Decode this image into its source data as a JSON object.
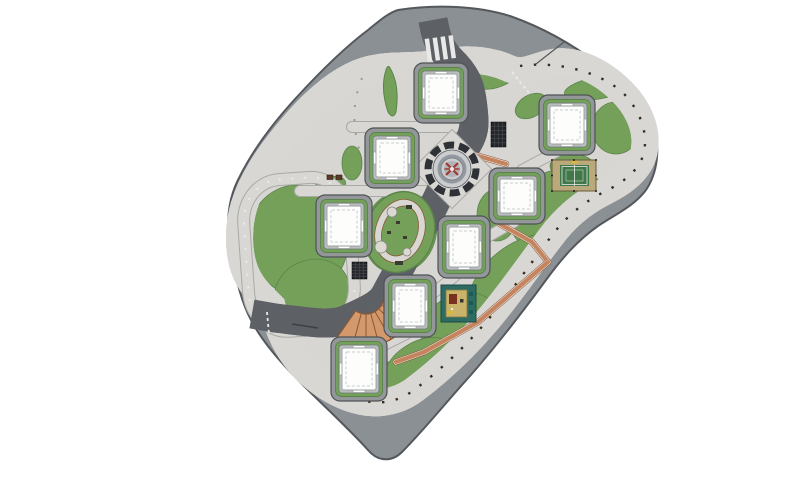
{
  "meta": {
    "type": "architectural-site-plan",
    "view": "top-down-masterplan",
    "background": "#ffffff"
  },
  "palette": {
    "road": "#8b9095",
    "road_edge": "#54585c",
    "plaza": "#d7d6d3",
    "sidewalk": "#d8d7d4",
    "sidewalk_edge": "#a9a9a5",
    "track": "#c5845e",
    "track_edge": "#7c4a30",
    "track_line": "#f2ece4",
    "lawn": "#74a05a",
    "lawn_edge": "#5b8449",
    "corridor": "#8e9296",
    "corridor_edge": "#5d6166",
    "pad": "#94979a",
    "pad_edge": "#4e5255",
    "pad_lawn": "#73a15a",
    "pad_lawn_edge": "#4f7a3e",
    "pad_band": "#b9bdbd",
    "pad_band_edge": "#73787c",
    "building": "#fdfdfc",
    "building_edge": "#9aa0a2",
    "building_detail": "#c9cdcd",
    "stairs": "#d3996c",
    "stairs_edge": "#8a5633",
    "fountain_dark": "#2e3237",
    "fountain_mid": "#caccce",
    "fountain_core": "#9298a0",
    "fountain_red": "#a23832",
    "court_base": "#b9a97b",
    "court_base_edge": "#6b5c3a",
    "court_green": "#41784a",
    "court_line": "#e8e8e6",
    "playcourt_frame": "#2e6b63",
    "playcourt_frame_edge": "#1d4a44",
    "playcourt_floor": "#c9b26a",
    "playcourt_floor_edge": "#8a7a40",
    "grate": "#24262a",
    "grate_line": "#4a4e54",
    "shrub_dot": "#3a2b1c",
    "lamp_dot": "#efeeea",
    "bench": "#5a3a2a",
    "marking_white": "#e9e9e7",
    "yellow_item": "#d8b93c"
  },
  "counts": {
    "buildings": 8,
    "lawn_patches": 17,
    "courts": 2
  },
  "buildings": [
    {
      "id": "block-1",
      "cx": 441,
      "cy": 93,
      "w": 54,
      "h": 60
    },
    {
      "id": "block-2",
      "cx": 392,
      "cy": 158,
      "w": 54,
      "h": 60
    },
    {
      "id": "block-3",
      "cx": 567,
      "cy": 125,
      "w": 56,
      "h": 60
    },
    {
      "id": "block-4",
      "cx": 517,
      "cy": 196,
      "w": 56,
      "h": 56
    },
    {
      "id": "block-5",
      "cx": 344,
      "cy": 226,
      "w": 56,
      "h": 62
    },
    {
      "id": "block-6",
      "cx": 464,
      "cy": 247,
      "w": 52,
      "h": 62
    },
    {
      "id": "block-7",
      "cx": 410,
      "cy": 306,
      "w": 52,
      "h": 62
    },
    {
      "id": "block-8",
      "cx": 359,
      "cy": 369,
      "w": 56,
      "h": 64
    }
  ],
  "lawns": [
    [
      298,
      240,
      50,
      55,
      -8
    ],
    [
      312,
      292,
      38,
      32,
      -20
    ],
    [
      497,
      74,
      25,
      13,
      -22
    ],
    [
      598,
      88,
      34,
      11,
      -10
    ],
    [
      616,
      128,
      24,
      26,
      0
    ],
    [
      560,
      212,
      52,
      42,
      -18
    ],
    [
      497,
      215,
      20,
      26,
      0
    ],
    [
      528,
      290,
      68,
      48,
      -38
    ],
    [
      462,
      330,
      42,
      36,
      -30
    ],
    [
      360,
      396,
      52,
      34,
      -18
    ],
    [
      420,
      368,
      40,
      26,
      -32
    ],
    [
      531,
      106,
      17,
      11,
      -30
    ],
    [
      352,
      163,
      10,
      17,
      0
    ],
    [
      375,
      148,
      9,
      16,
      10
    ],
    [
      400,
      232,
      36,
      42,
      18
    ],
    [
      330,
      186,
      16,
      9,
      -15
    ],
    [
      572,
      166,
      22,
      12,
      0
    ]
  ],
  "walkways": [
    [
      [
        300,
        191
      ],
      [
        438,
        191
      ]
    ],
    [
      [
        352,
        127
      ],
      [
        472,
        127
      ]
    ],
    [
      [
        556,
        152
      ],
      [
        522,
        170
      ]
    ],
    [
      [
        514,
        222
      ],
      [
        482,
        240
      ]
    ],
    [
      [
        455,
        276
      ],
      [
        424,
        300
      ]
    ],
    [
      [
        406,
        334
      ],
      [
        382,
        346
      ]
    ]
  ],
  "trails": [
    [
      [
        468,
        153
      ],
      [
        506,
        164
      ]
    ],
    [
      [
        500,
        224
      ],
      [
        532,
        242
      ],
      [
        548,
        262
      ]
    ],
    [
      [
        548,
        262
      ],
      [
        478,
        322
      ],
      [
        424,
        352
      ],
      [
        396,
        362
      ]
    ]
  ],
  "grates": [
    {
      "x": 491,
      "y": 122,
      "w": 15,
      "h": 25
    },
    {
      "x": 352,
      "y": 262,
      "w": 15,
      "h": 17
    }
  ],
  "benches": [
    {
      "x": 327,
      "y": 175,
      "w": 6,
      "h": 4.5
    },
    {
      "x": 336,
      "y": 175,
      "w": 6,
      "h": 4.5
    }
  ],
  "playground_items": {
    "circles": [
      {
        "cx": 392,
        "cy": 212,
        "r": 5
      },
      {
        "cx": 381,
        "cy": 247,
        "r": 6
      },
      {
        "cx": 407,
        "cy": 252,
        "r": 4
      }
    ],
    "blocks": [
      {
        "x": 396,
        "y": 221,
        "w": 4,
        "h": 3
      },
      {
        "x": 387,
        "y": 231,
        "w": 4,
        "h": 3
      },
      {
        "x": 403,
        "y": 236,
        "w": 4,
        "h": 3
      },
      {
        "x": 406,
        "y": 205,
        "w": 6,
        "h": 4
      },
      {
        "x": 395,
        "y": 261,
        "w": 8,
        "h": 4
      }
    ]
  },
  "fountain": {
    "cx": 452,
    "cy": 169
  },
  "tennis_court": {
    "x": 552,
    "y": 160,
    "w": 44,
    "h": 31
  },
  "kids_court": {
    "x": 441,
    "y": 285,
    "w": 35,
    "h": 37
  }
}
